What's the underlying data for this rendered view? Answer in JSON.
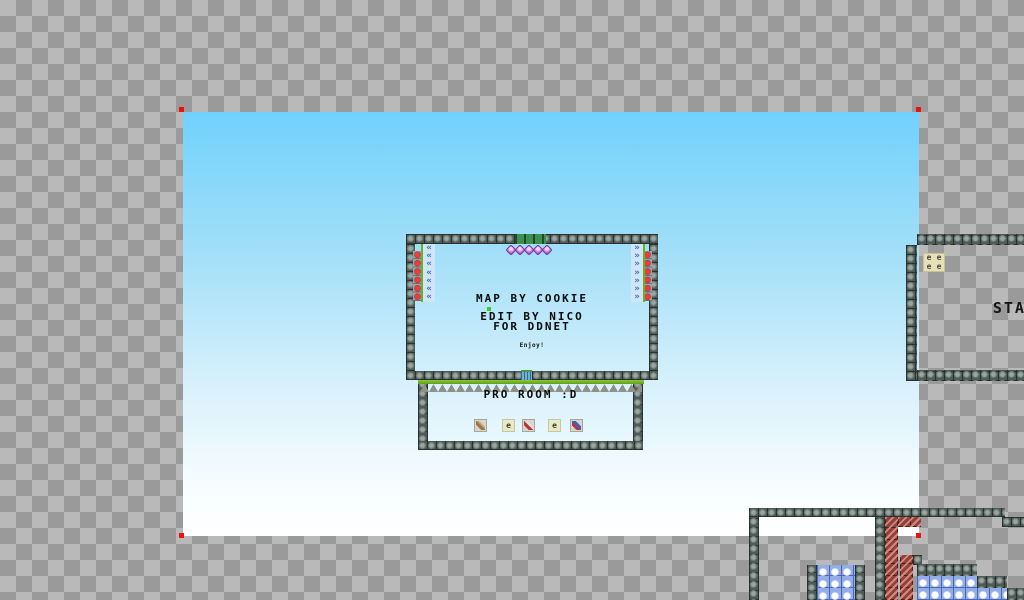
{
  "background": {
    "checker_dark": "#9a9a9a",
    "checker_light": "#b9b9b9"
  },
  "map_layer": {
    "sky_top_color": "#70d1fc",
    "sky_bottom_color": "#ffffff",
    "corner_marker_color": "#ee1111"
  },
  "main_room": {
    "title_line1": "MAP BY COOKIE",
    "title_line2": "EDIT BY NICO",
    "title_line3": "FOR DDNET",
    "note": "Enjoy!"
  },
  "pro_room": {
    "label": "PRO ROOM :D",
    "ammo_letter": "e"
  },
  "stage_room": {
    "label": "STAGE",
    "ammo_letter": "e"
  },
  "tiles": {
    "wall_color": "#4e5a56",
    "kill_tile_color": "#93403a",
    "freeze_tile_color": "#93aee6",
    "grass_color": "#76b82a",
    "stopper_color": "#4a6ac8",
    "gem_color": "#c878dd",
    "red_dot_color": "#ef3b3b"
  }
}
